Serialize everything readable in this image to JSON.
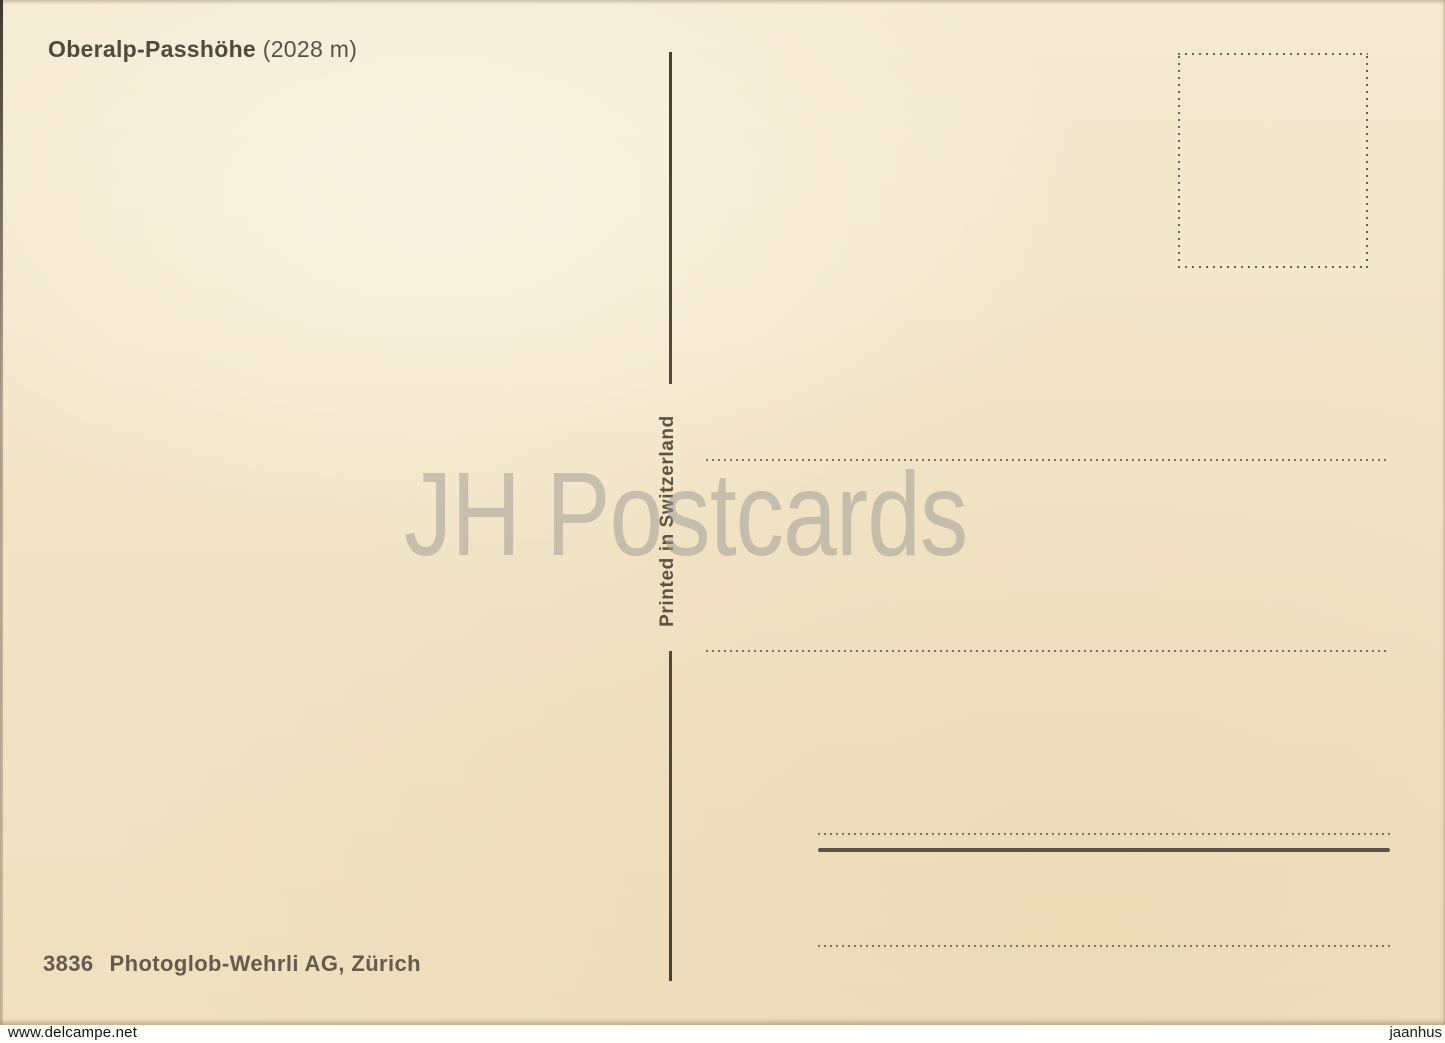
{
  "postcard": {
    "title": {
      "name": "Oberalp-Passhöhe",
      "elevation": "(2028 m)"
    },
    "printed_note": "Printed in Switzerland",
    "publisher": {
      "number": "3836",
      "name": "Photoglob-Wehrli AG, Zürich"
    }
  },
  "watermark": {
    "text": "JH Postcards"
  },
  "footer": {
    "left": "www.delcampe.net",
    "right": "jaanhus"
  },
  "colors": {
    "card_background": "#f2e5c8",
    "ink": "#55493a",
    "dotted_line": "#7d7264",
    "watermark": "#c9c6bd",
    "scan_background": "#fdfdfc"
  }
}
